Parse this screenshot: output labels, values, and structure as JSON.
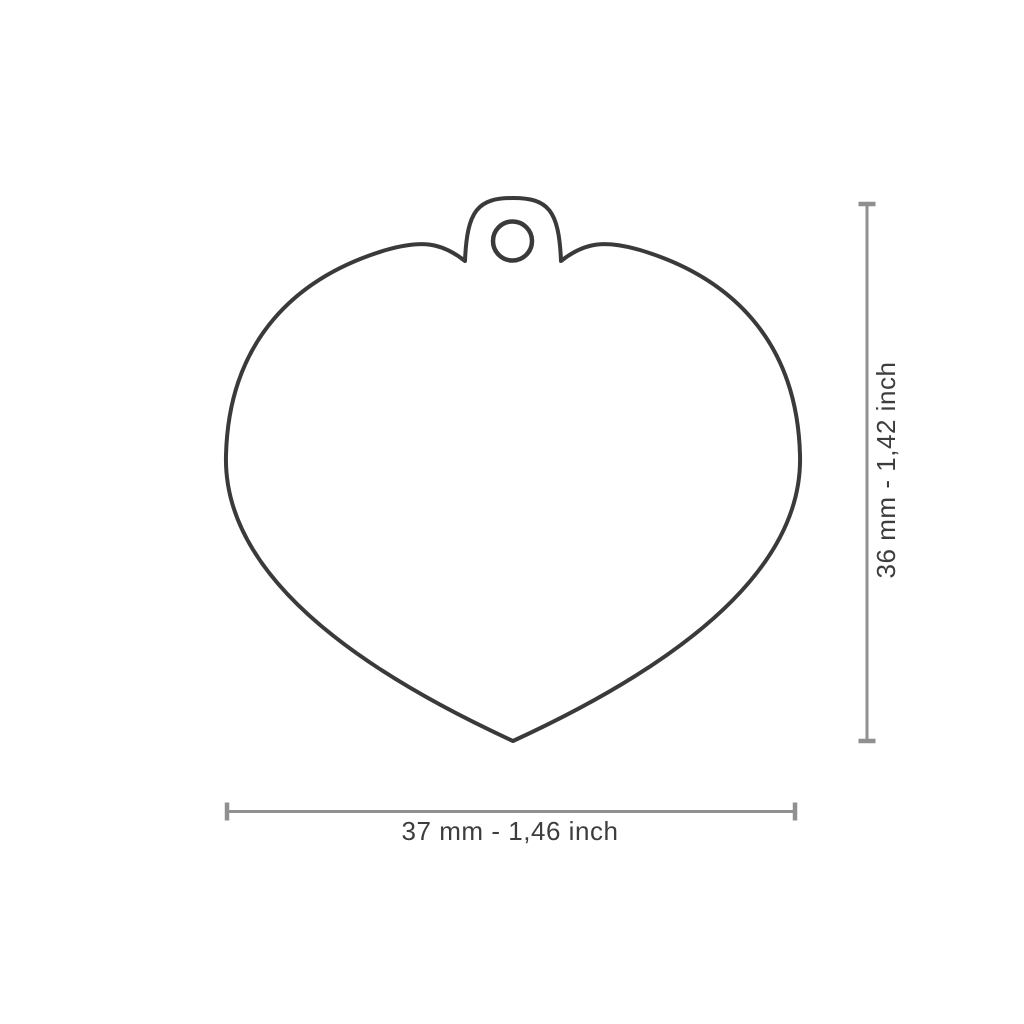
{
  "diagram": {
    "tag_shape": "heart",
    "width_label": "37 mm - 1,46 inch",
    "height_label": "36 mm - 1,42 inch",
    "colors": {
      "background": "#ffffff",
      "tag_outline": "#3a3a3c",
      "dimension_line": "#8f9092",
      "label_text": "#3d3d3f"
    }
  }
}
